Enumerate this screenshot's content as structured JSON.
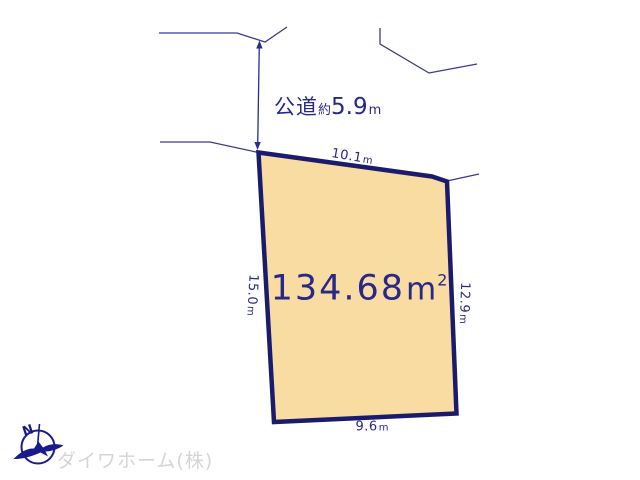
{
  "road_label": {
    "prefix": "公道",
    "approx": "約",
    "value": "5.9",
    "unit": "m"
  },
  "plot": {
    "area_label": {
      "value": "134.68",
      "unit": "m",
      "exponent": "2"
    },
    "dim_top": {
      "value": "10.1",
      "unit": "m"
    },
    "dim_left": {
      "value": "15.0",
      "unit": "m"
    },
    "dim_right": {
      "value": "12.9",
      "unit": "m"
    },
    "dim_bottom": {
      "value": "9.6",
      "unit": "m"
    }
  },
  "compass": {
    "north_label": "N"
  },
  "logo": {
    "company_name": "ダイワホーム(株)"
  },
  "colors": {
    "thin_line": "#3a3a94",
    "plot_border": "#1b1b6e",
    "plot_fill": "#f8dca1",
    "dim_text": "#28288a",
    "logo_text": "#d5d5d5",
    "compass": "#1a1a8c"
  }
}
